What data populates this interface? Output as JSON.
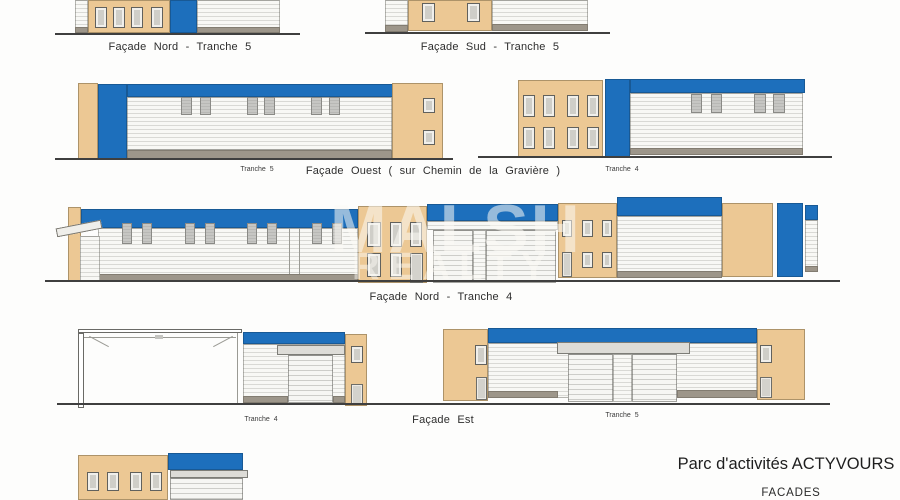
{
  "document": {
    "project_title": "Parc d'activités ACTYVOURS",
    "sheet_title": "FACADES",
    "watermark": {
      "line1": "MALSH",
      "line2": "REALTY"
    }
  },
  "elevations": {
    "row1_left_label": "Façade Nord - Tranche 5",
    "row1_right_label": "Façade Sud - Tranche 5",
    "row2_left_tag": "Tranche 5",
    "row2_center_label": "Façade Ouest ( sur Chemin de la Gravière )",
    "row2_right_tag": "Tranche 4",
    "row3_label": "Façade Nord - Tranche 4",
    "row4_left_tag": "Tranche 4",
    "row4_center_label": "Façade Est",
    "row4_right_tag": "Tranche 5"
  },
  "colors": {
    "accent_blue": "#1d6fbc",
    "wall_tan": "#ecc894",
    "plinth_gray": "#9d968a",
    "siding_white": "#f8f8f5"
  }
}
